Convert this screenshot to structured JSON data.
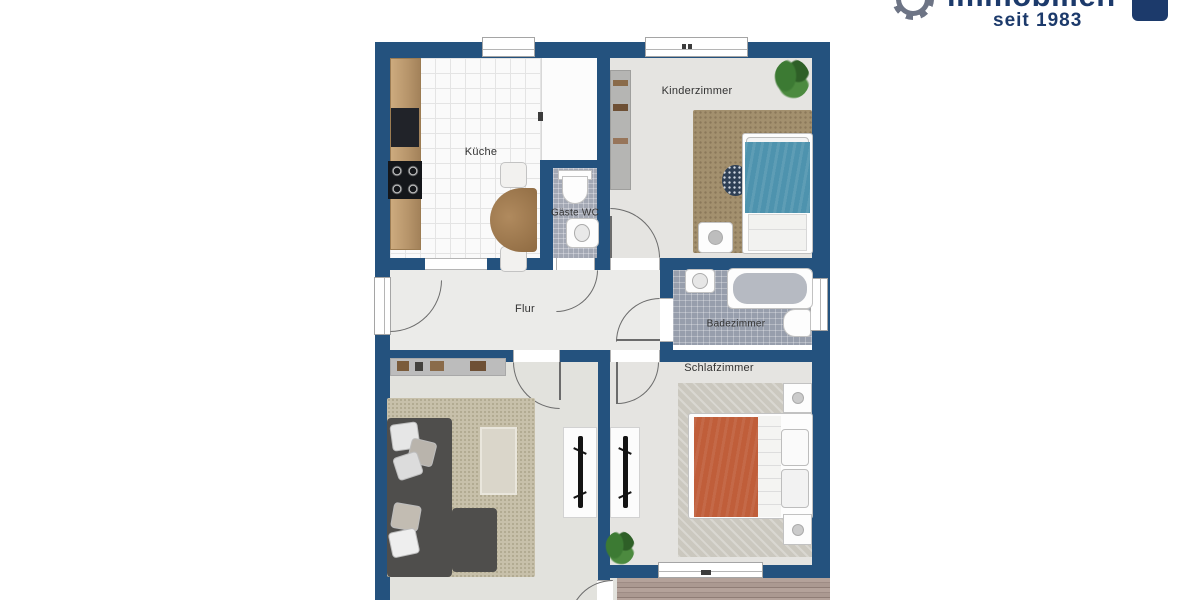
{
  "brand": {
    "name": "immobilien",
    "tagline": "seit 1983",
    "badge": "IVB"
  },
  "floor_plan": {
    "rooms": {
      "kueche": "Küche",
      "gaeste_wc": "Gäste WC",
      "kinderzimmer": "Kinderzimmer",
      "flur": "Flur",
      "badezimmer": "Badezimmer",
      "schlafzimmer": "Schlafzimmer"
    }
  },
  "colors": {
    "wall_blue": "#24527e",
    "brand_navy": "#1c3a6b",
    "kid_bed_blue": "#4e93ae",
    "duvet_orange": "#c05e3a",
    "kinder_rug_brown": "#a3906e",
    "living_rug_beige": "#c7c0aa"
  }
}
